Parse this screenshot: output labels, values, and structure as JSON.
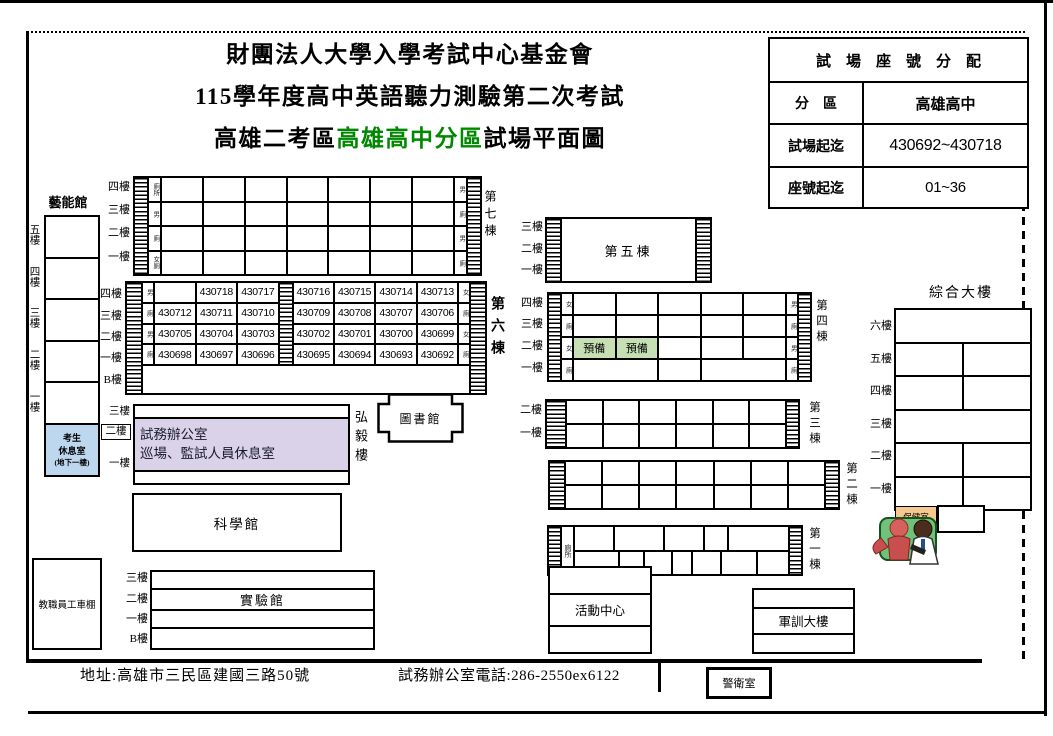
{
  "header": {
    "org": "財團法人大學入學考試中心基金會",
    "exam": "115學年度高中英語聽力測驗第二次考試",
    "map_prefix": "高雄二考區",
    "map_highlight": "高雄高中分區",
    "map_suffix": "試場平面圖"
  },
  "assign_table": {
    "title": "試　場　座　號　分　配",
    "rows": [
      {
        "label": "分　區",
        "value": "高雄高中"
      },
      {
        "label": "試場起迄",
        "value": "430692~430718"
      },
      {
        "label": "座號起迄",
        "value": "01~36"
      }
    ]
  },
  "yineng": {
    "title": "藝能館",
    "floors": [
      "五樓",
      "四樓",
      "三樓",
      "二樓",
      "一樓"
    ],
    "rest_lines": [
      "考生",
      "休息室",
      "(地下一樓)"
    ]
  },
  "b7": {
    "name": "第七棟",
    "floors": [
      "四樓",
      "三樓",
      "二樓",
      "一樓"
    ],
    "wc_left": [
      "廁所",
      "男",
      "廁",
      "女廁"
    ],
    "wc_right": [
      "男",
      "廁",
      "男",
      "廁"
    ]
  },
  "b6": {
    "name": "第六棟",
    "floors": [
      "四樓",
      "三樓",
      "二樓",
      "一樓",
      "B樓"
    ],
    "wc_left": [
      "男",
      "廁",
      "男",
      "廁"
    ],
    "wc_right": [
      "女",
      "廁",
      "女",
      "廁"
    ],
    "rooms_left": [
      [
        "",
        "430718",
        "430717"
      ],
      [
        "430712",
        "430711",
        "430710"
      ],
      [
        "430705",
        "430704",
        "430703"
      ],
      [
        "430698",
        "430697",
        "430696"
      ]
    ],
    "rooms_right": [
      [
        "430716",
        "430715",
        "430714",
        "430713"
      ],
      [
        "430709",
        "430708",
        "430707",
        "430706"
      ],
      [
        "430702",
        "430701",
        "430700",
        "430699"
      ],
      [
        "430695",
        "430694",
        "430693",
        "430692"
      ]
    ]
  },
  "b5": {
    "name": "第五棟",
    "floors": [
      "三樓",
      "二樓",
      "一樓"
    ]
  },
  "b4": {
    "name": "第四棟",
    "floors": [
      "四樓",
      "三樓",
      "二樓",
      "一樓"
    ],
    "wc_left": [
      "女",
      "廁",
      "女",
      "廁"
    ],
    "wc_right": [
      "男",
      "廁",
      "男",
      "廁"
    ],
    "reserve": "預備"
  },
  "b3": {
    "name": "第三棟",
    "floors": [
      "二樓",
      "一樓"
    ]
  },
  "b2": {
    "name": "第二棟"
  },
  "b1": {
    "name": "第一棟",
    "wc": "廁所"
  },
  "library": {
    "name": "圖書館"
  },
  "hongyi": {
    "name": "弘毅樓",
    "floors": [
      "三樓",
      "二樓",
      "一樓"
    ],
    "line1": "試務辦公室",
    "line2": "巡場、監試人員休息室"
  },
  "science": {
    "name": "科學館"
  },
  "lab": {
    "name": "實驗館",
    "floors": [
      "三樓",
      "二樓",
      "一樓",
      "B樓"
    ]
  },
  "parking": {
    "name": "教職員工車棚"
  },
  "activity": {
    "name": "活動中心"
  },
  "military": {
    "name": "軍訓大樓"
  },
  "complex": {
    "name": "綜合大樓",
    "floors": [
      "六樓",
      "五樓",
      "四樓",
      "三樓",
      "二樓",
      "一樓"
    ],
    "health": "保健室"
  },
  "guard": {
    "name": "警衛室"
  },
  "footer": {
    "address": "地址:高雄市三民區建國三路50號",
    "phone": "試務辦公室電話:286-2550ex6122"
  },
  "colors": {
    "highlight_green": "#008800",
    "rest_blue": "#BDD7EE",
    "reserve_green": "#C6E0B4",
    "office_lavender": "#D9D2E9",
    "health_tan": "#F5C88F"
  }
}
